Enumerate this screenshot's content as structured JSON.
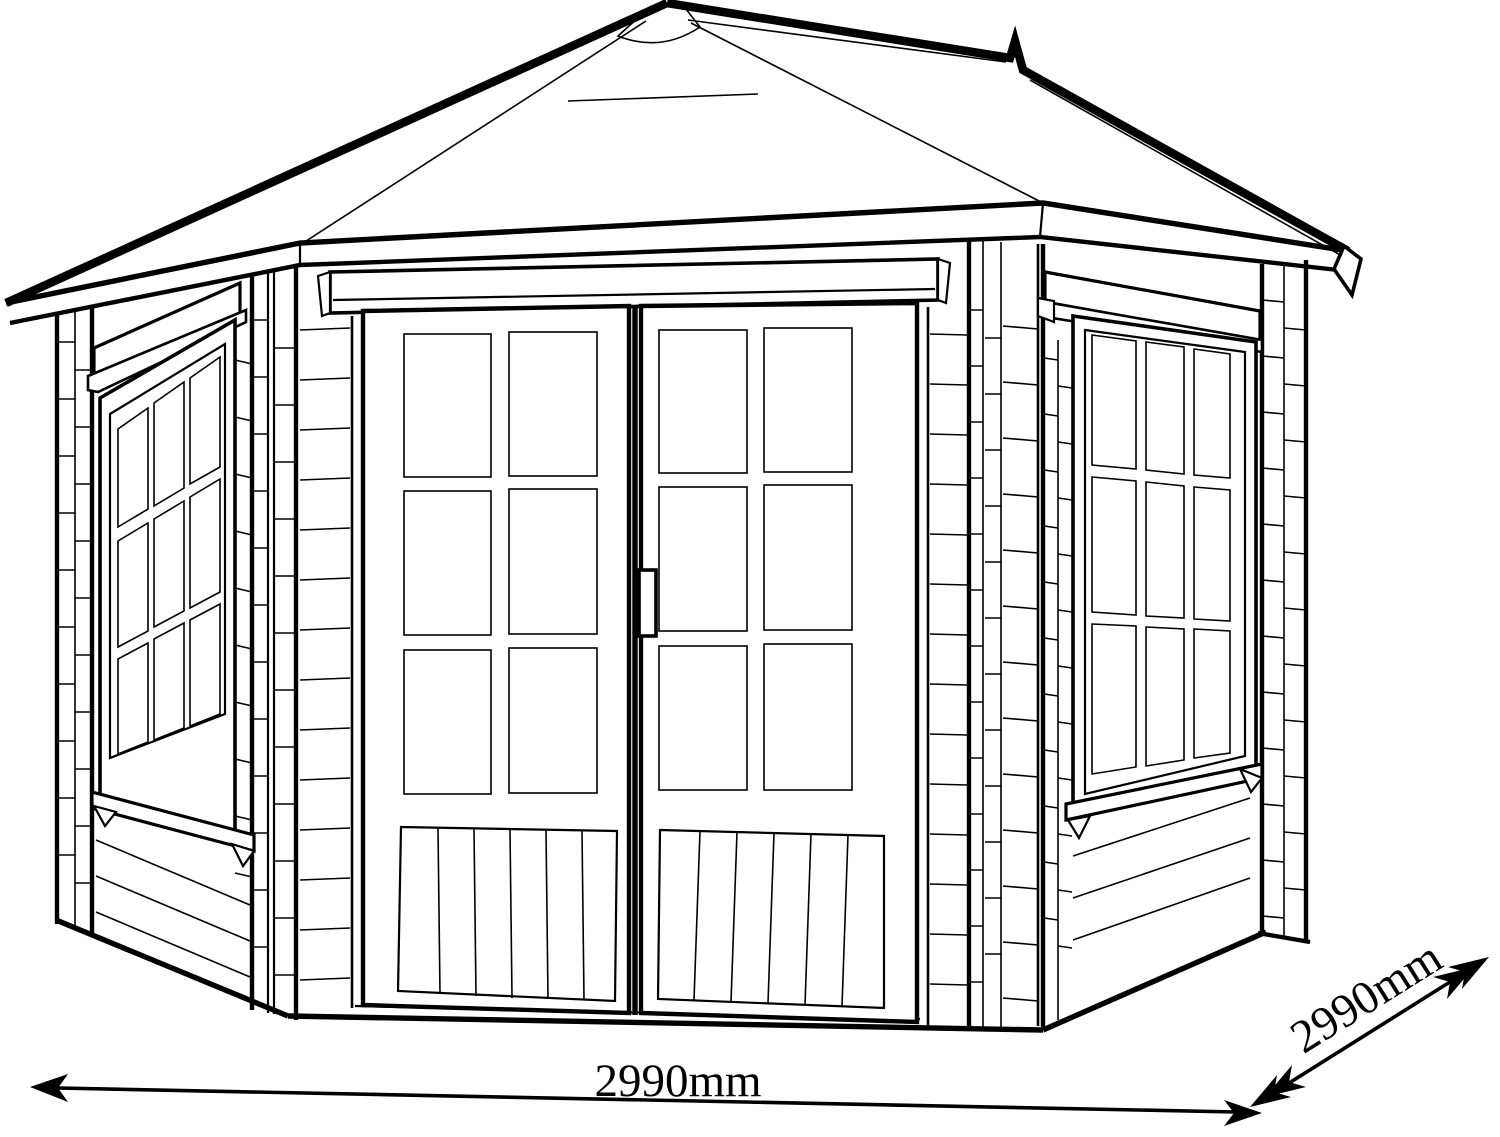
{
  "diagram": {
    "type": "technical line drawing",
    "subject": "pentagonal corner summerhouse with hipped roof, double glazed doors and two side windows",
    "background": "#ffffff",
    "line_color": "#000000",
    "dimensions": {
      "width": {
        "label": "2990mm"
      },
      "depth": {
        "label": "2990mm"
      }
    },
    "structure": {
      "doors": 2,
      "door_pane_rows": 3,
      "door_pane_cols": 2,
      "door_bottom_planks": 6,
      "windows": 2,
      "window_pane_rows": 3,
      "window_pane_cols": 3
    }
  }
}
